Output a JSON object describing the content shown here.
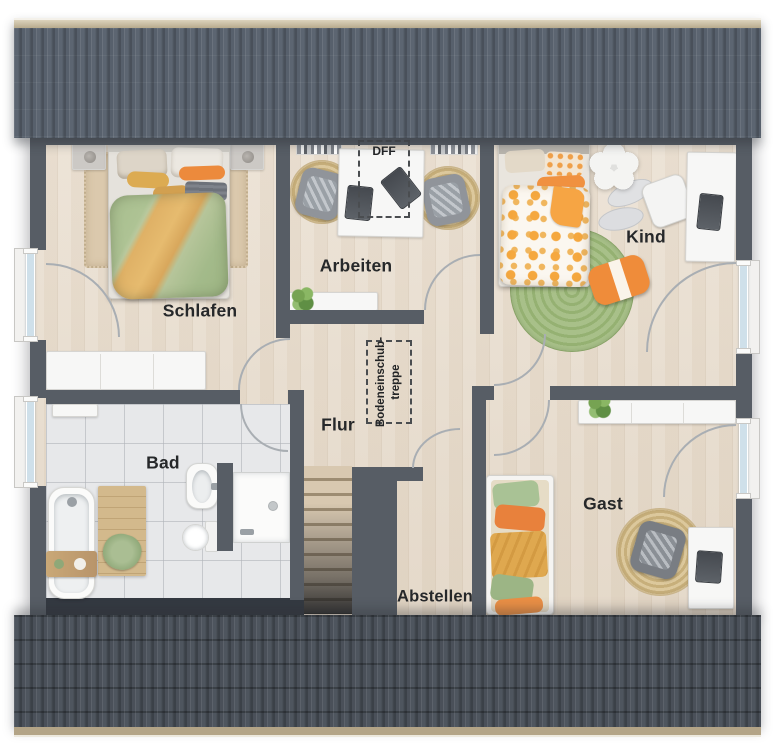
{
  "rooms": [
    {
      "id": "schlafen",
      "label": "Schlafen"
    },
    {
      "id": "arbeiten",
      "label": "Arbeiten"
    },
    {
      "id": "kind",
      "label": "Kind"
    },
    {
      "id": "flur",
      "label": "Flur"
    },
    {
      "id": "bad",
      "label": "Bad"
    },
    {
      "id": "abstellen",
      "label": "Abstellen"
    },
    {
      "id": "gast",
      "label": "Gast"
    }
  ],
  "annotations": {
    "roof_window": {
      "label": "DFF"
    },
    "attic_hatch": {
      "line1": "Bodeneinschub-",
      "line2": "treppe"
    }
  },
  "fixtures": {
    "schlafen": [
      "double-bed",
      "nightstand-left",
      "nightstand-right",
      "area-rug",
      "wardrobe",
      "window"
    ],
    "arbeiten": [
      "desk",
      "office-chair-left",
      "office-chair-right",
      "bookshelf-left",
      "bookshelf-right",
      "sideboard",
      "plant",
      "roof-window-dff"
    ],
    "kind": [
      "single-bed",
      "flower-mirror",
      "play-rug-1",
      "play-rug-2",
      "round-green-rug",
      "floor-cushion",
      "desk",
      "monitor",
      "chair",
      "window"
    ],
    "flur": [
      "attic-hatch",
      "staircase"
    ],
    "bad": [
      "radiator-shelf",
      "bathtub",
      "bath-caddy",
      "wooden-mat",
      "towel",
      "washbasin",
      "toilet",
      "shower",
      "window"
    ],
    "abstellen": [],
    "gast": [
      "daybed",
      "sideboard",
      "plant",
      "round-jute-rug",
      "armchair",
      "desk",
      "laptop",
      "window"
    ]
  },
  "palette": {
    "roof_top": "#59626e",
    "roof_bottom": "#4c535c",
    "roof_ridge": "#cdc2a6",
    "wall": "#575d65",
    "wood_floor": "#e8ddcf",
    "tile_floor": "#e7e8ea",
    "accent_orange": "#ec8c3e",
    "accent_green": "#a9bf90",
    "accent_mustard": "#dda94e",
    "rug_jute": "#d0ba8c",
    "rug_green": "#9fba7f",
    "furniture_white": "#f6f6f5",
    "window_glass": "#cfe0ea",
    "label_text": "#26282a"
  }
}
